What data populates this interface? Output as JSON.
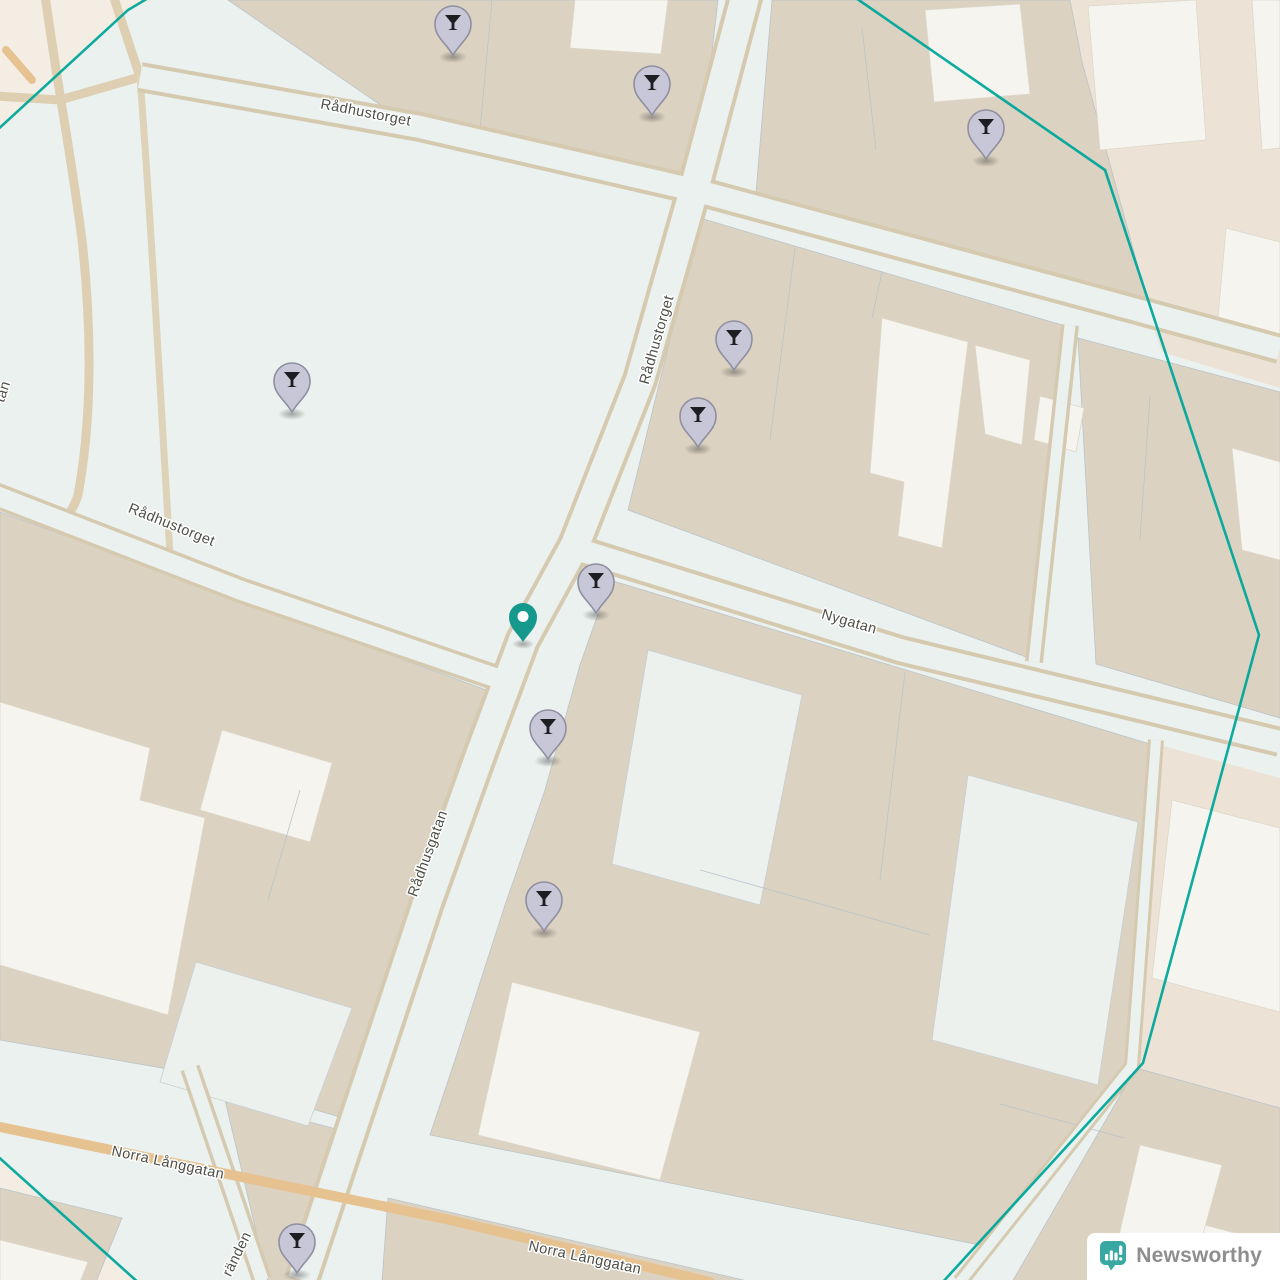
{
  "map": {
    "street_labels": [
      {
        "text": "Rådhustorget",
        "x": 365,
        "y": 117,
        "rot": 11
      },
      {
        "text": "Rådhustorget",
        "x": 170,
        "y": 529,
        "rot": 22
      },
      {
        "text": "Rådhustorget",
        "x": 661,
        "y": 341,
        "rot": -74
      },
      {
        "text": "Nygatan",
        "x": 848,
        "y": 626,
        "rot": 16
      },
      {
        "text": "Rådhusgatan",
        "x": 432,
        "y": 855,
        "rot": -70
      },
      {
        "text": "Norra Långgatan",
        "x": 167,
        "y": 1167,
        "rot": 12
      },
      {
        "text": "Norra Långgatan",
        "x": 584,
        "y": 1262,
        "rot": 12
      },
      {
        "text": "ränden",
        "x": 241,
        "y": 1256,
        "rot": -64
      },
      {
        "text": "tan",
        "x": 7,
        "y": 393,
        "rot": -72
      }
    ],
    "poi_pins": [
      {
        "x": 453,
        "y": 55
      },
      {
        "x": 652,
        "y": 115
      },
      {
        "x": 986,
        "y": 159
      },
      {
        "x": 734,
        "y": 370
      },
      {
        "x": 698,
        "y": 447
      },
      {
        "x": 292,
        "y": 412
      },
      {
        "x": 596,
        "y": 613
      },
      {
        "x": 548,
        "y": 759
      },
      {
        "x": 544,
        "y": 931
      },
      {
        "x": 297,
        "y": 1273
      }
    ],
    "poi_icon": "cocktail-icon",
    "location_pin": {
      "x": 523,
      "y": 642,
      "icon": "location-pin-icon"
    },
    "boundary": {
      "color": "#00a79b",
      "segments": [
        "155,-6 128,10 -6,133",
        "850,-6 1105,170 1259,635 1143,1063 941,1284",
        "-6,1153 140,1284"
      ]
    },
    "colors": {
      "ground": "#ebf1ee",
      "building_block": "#dbd2c1",
      "building_white": "#f6f4ee",
      "landuse_outer": "#ece2d6",
      "road_casing": "#d5cab0",
      "road_orange": "#e7c291",
      "poi_pin_fill": "#c7c7d8",
      "poi_pin_stroke": "#8f8fa2",
      "location_pin_fill": "#16998d",
      "label_text": "#4e4e48"
    }
  },
  "attribution": {
    "brand": "Newsworthy",
    "logo_icon": "newsworthy-chart-bubble-icon",
    "logo_color": "#3aa8a2"
  }
}
